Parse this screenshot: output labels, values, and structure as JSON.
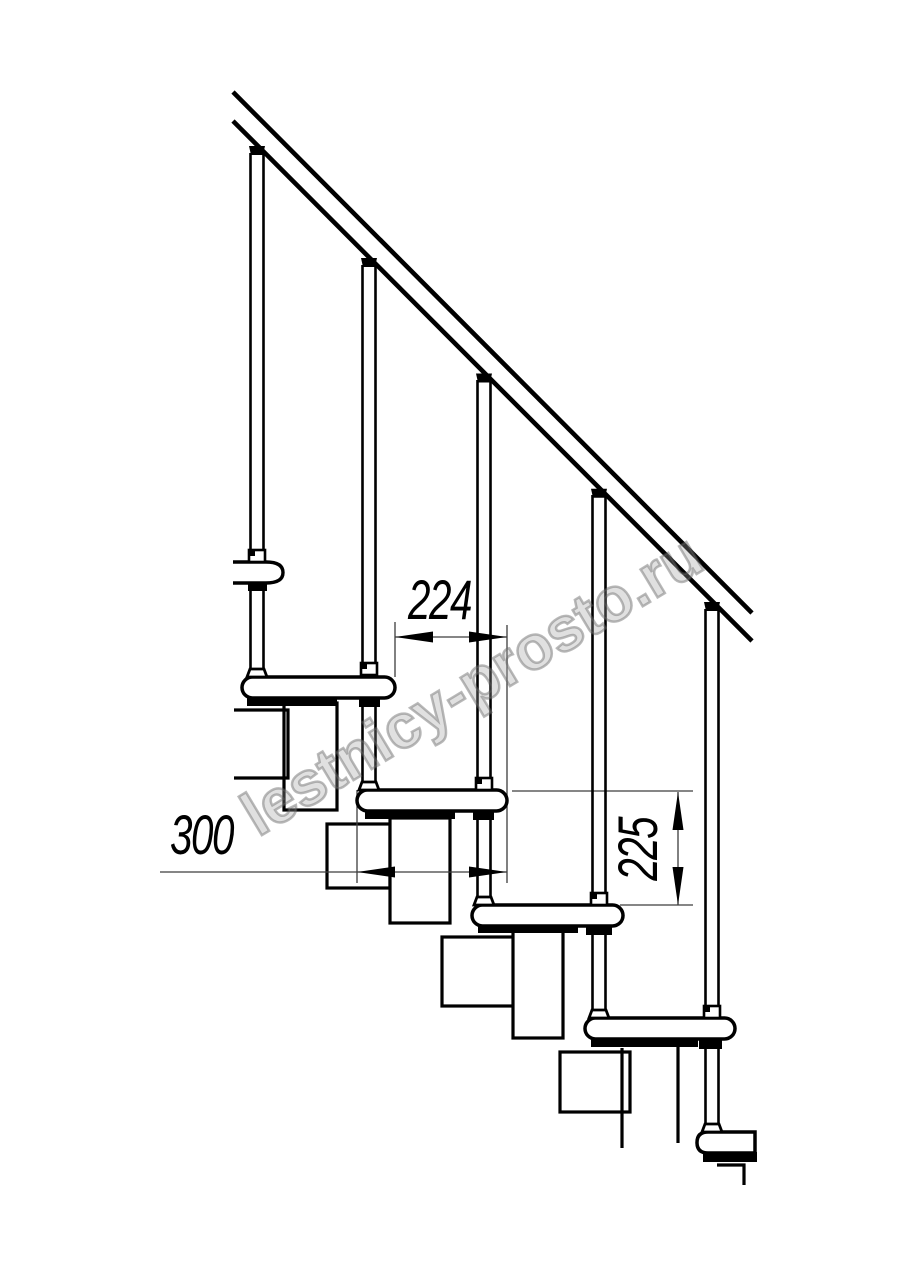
{
  "watermark": {
    "text": "lestnicy-prosto.ru"
  },
  "dimensions": {
    "step_run": {
      "label": "224",
      "orientation": "horizontal"
    },
    "step_depth": {
      "label": "300",
      "orientation": "horizontal"
    },
    "step_rise": {
      "label": "225",
      "orientation": "vertical"
    }
  },
  "colors": {
    "line": "#000000",
    "thin_line": "#3d3d3d",
    "background": "#ffffff",
    "watermark_stroke": "#696969"
  }
}
